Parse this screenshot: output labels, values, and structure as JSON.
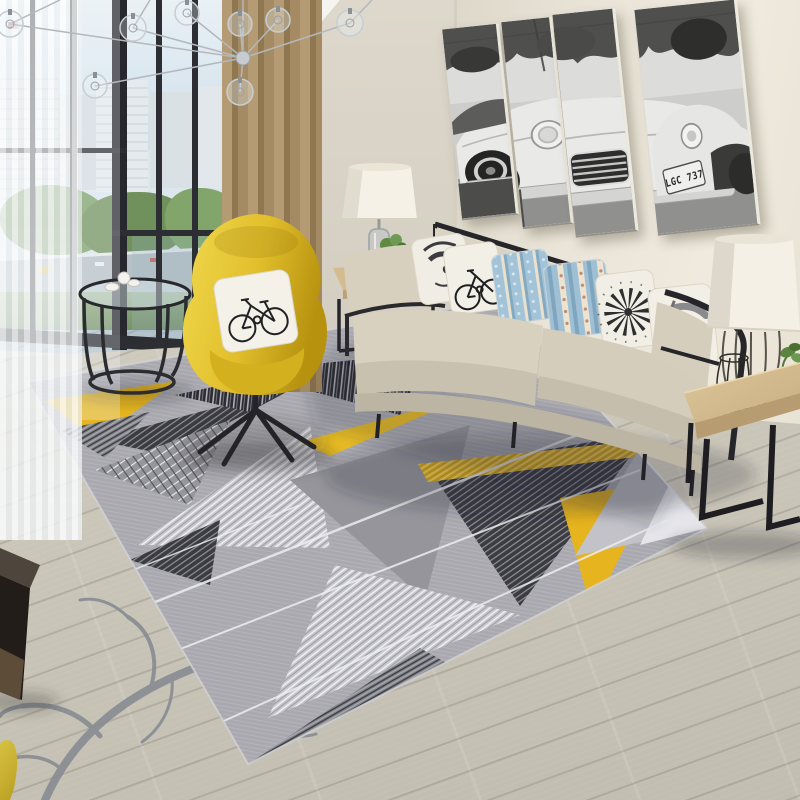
{
  "scene": {
    "title": "Modern living room with geometric area rug",
    "license_plate": "LGC 737",
    "objects": {
      "rug": "gray-yellow geometric triangle rug",
      "chair": "yellow wingback swivel chair",
      "sofa": "beige fabric sofa with black metal frame",
      "wall_art": "four-panel black and white classic car print",
      "window": "floor-to-ceiling balcony window with city view",
      "chandelier": "glass globe sputnik chandelier",
      "curtain": "tan curtain with white sheer",
      "floor": "light gray wood plank floor",
      "decal": "gray branch decal on floor"
    },
    "pillows": [
      "abstract face print",
      "bicycle print",
      "blue floral stripe",
      "blue floral stripe wide",
      "dandelion print",
      "gray abstract print"
    ],
    "palette": {
      "wall": "#eae5d8",
      "side_wall": "#d8d3c6",
      "ceiling": "#f6f4ee",
      "floor": "#cfcbbf",
      "balcony_floor": "#aebfc9",
      "curtain_tan": "#a98f68",
      "window_frame": "#2c2e33",
      "rug_base": "#a9a9af",
      "rug_dark": "#3b3b41",
      "rug_yellow": "#e5b51f",
      "rug_light": "#c7c7cd",
      "chair_yellow": "#e2bf2c",
      "sofa_beige": "#d5cdbb",
      "pillow_blue": "#9fc0d4",
      "wood": "#d2ba8e",
      "metal_black": "#26262a",
      "branch": "#868a91"
    }
  }
}
